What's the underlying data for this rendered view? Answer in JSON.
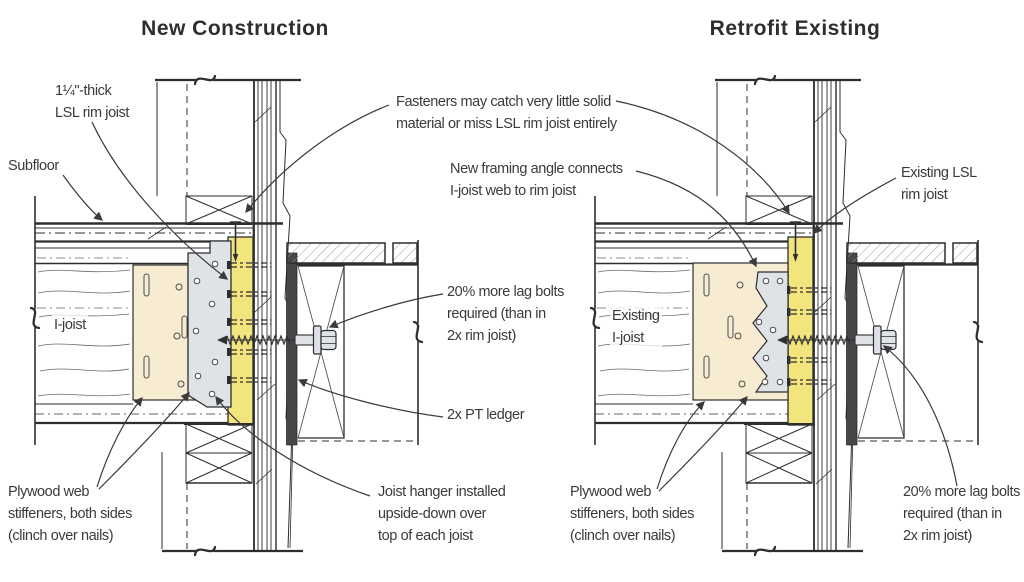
{
  "titles": {
    "left": "New Construction",
    "right": "Retrofit Existing"
  },
  "labels": {
    "lsl_rim_joist": "1¼\"-thick\nLSL rim joist",
    "subfloor": "Subfloor",
    "i_joist": "I-joist",
    "plywood_web_left": "Plywood web\nstiffeners, both sides\n(clinch over nails)",
    "joist_hanger": "Joist hanger installed\nupside-down over\ntop of each joist",
    "fasteners": "Fasteners may catch very little solid\nmaterial or miss LSL rim joist entirely",
    "framing_angle": "New framing angle connects\nI-joist web to rim joist",
    "lag_bolts_left": "20% more lag bolts\nrequired (than in\n2x rim joist)",
    "pt_ledger": "2x PT ledger",
    "existing_rim_joist": "Existing LSL\nrim joist",
    "existing_i_joist": "Existing\nI-joist",
    "plywood_web_right": "Plywood web\nstiffeners, both sides\n(clinch over nails)",
    "lag_bolts_right": "20% more lag bolts\nrequired (than in\n2x rim joist)"
  },
  "colors": {
    "rim": "#f2e57e",
    "cream": "#f7ecd2",
    "hw": "#dfe3e8",
    "ink": "#2e2e30",
    "label": "#3a3a3c",
    "ledger": "#47474a"
  }
}
